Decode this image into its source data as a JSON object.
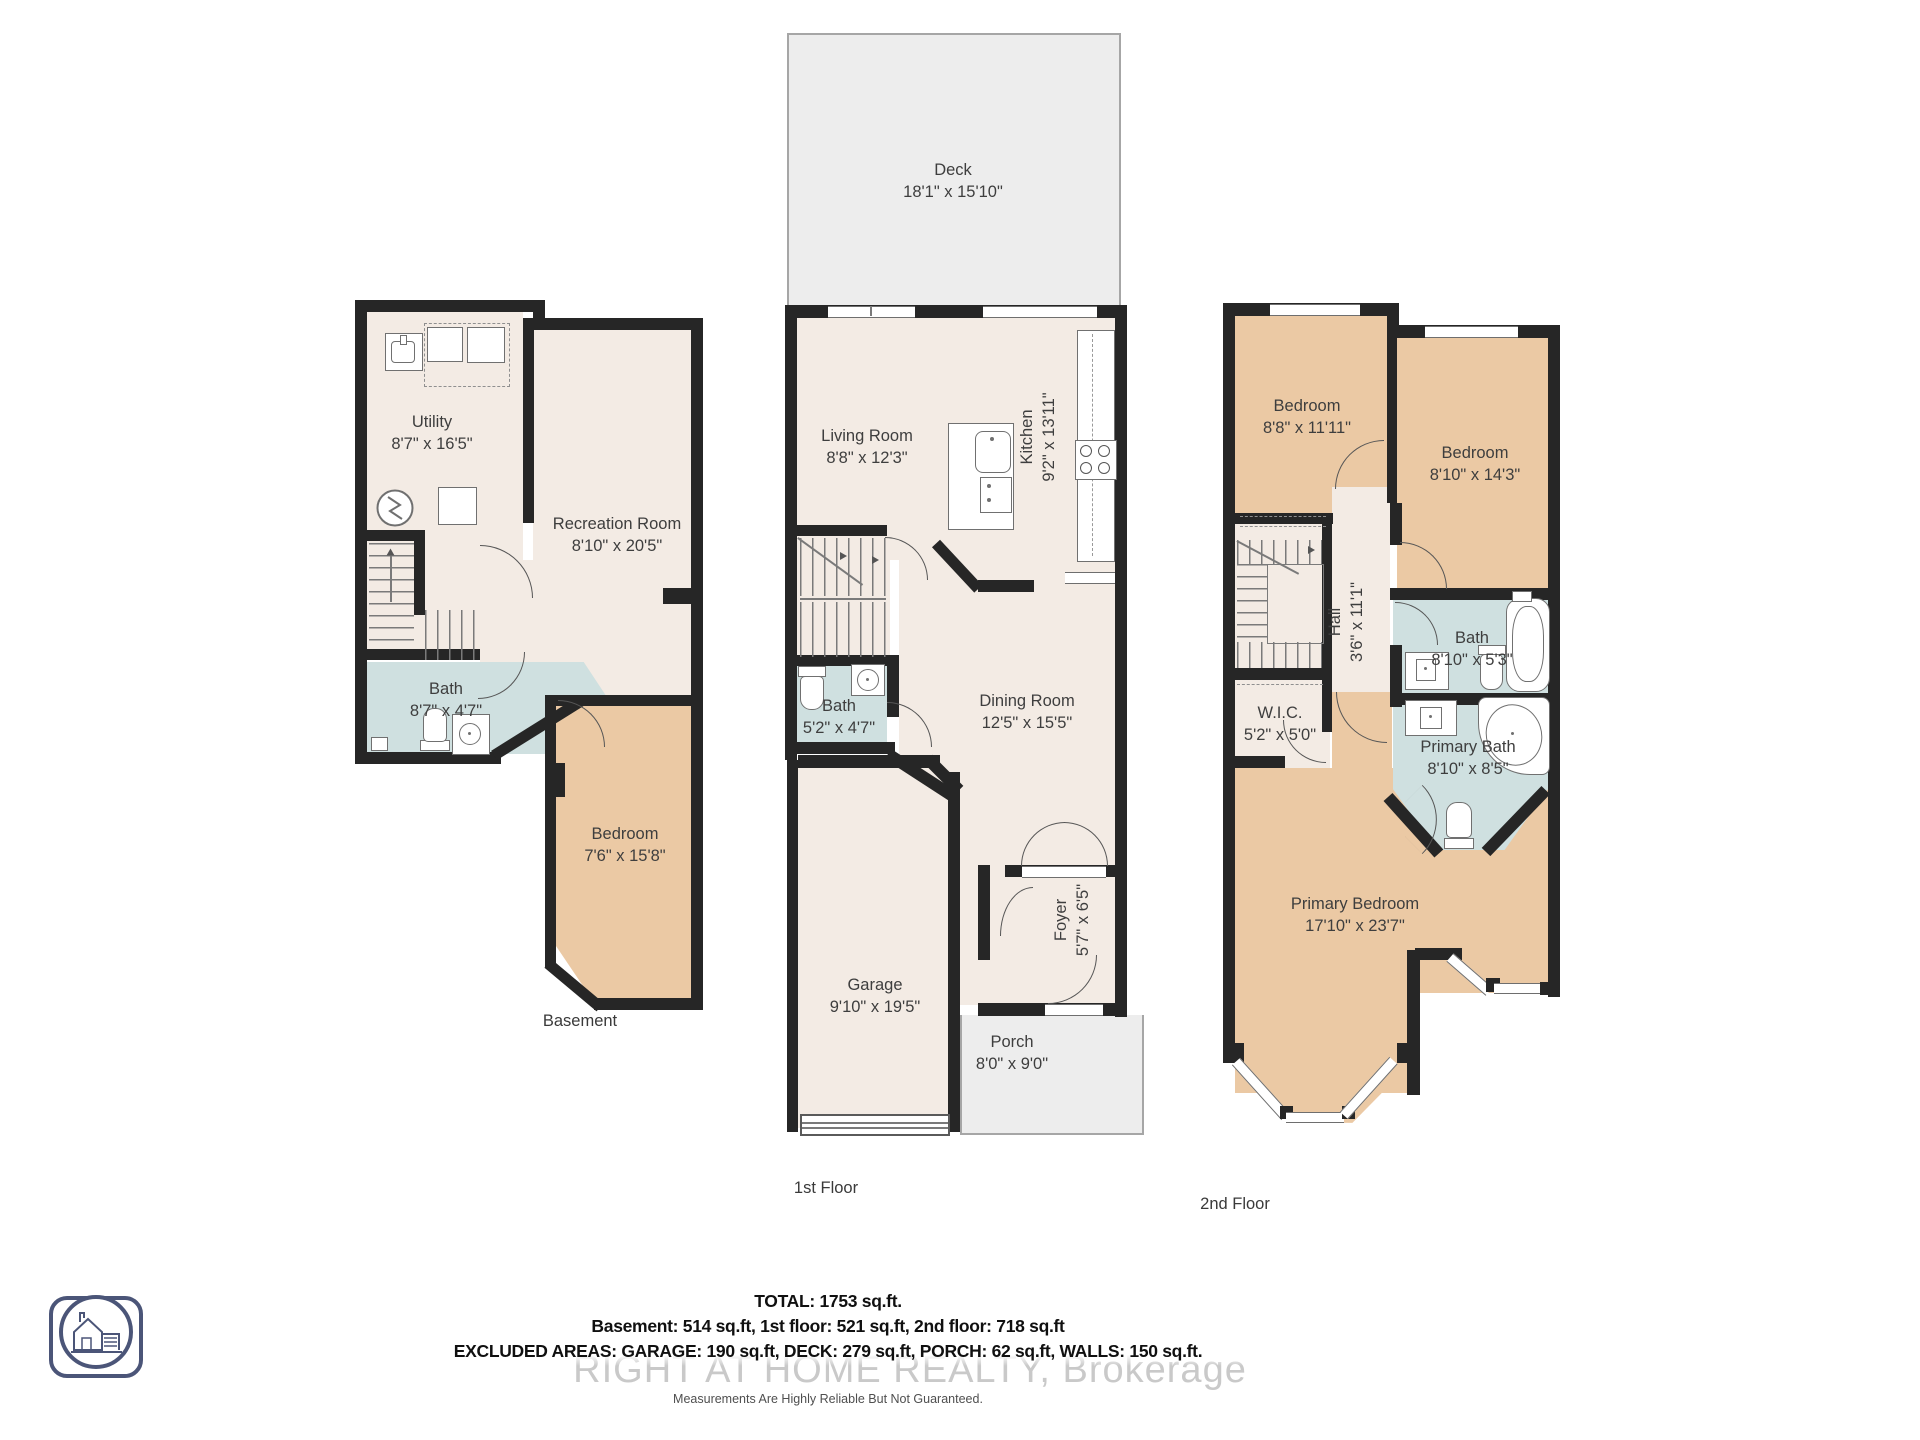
{
  "floors": {
    "basement": {
      "label": "Basement",
      "rooms": {
        "utility": {
          "name": "Utility",
          "dims": "8'7\" x 16'5\""
        },
        "recreation": {
          "name": "Recreation Room",
          "dims": "8'10\" x 20'5\""
        },
        "bath": {
          "name": "Bath",
          "dims": "8'7\" x 4'7\""
        },
        "bedroom": {
          "name": "Bedroom",
          "dims": "7'6\" x 15'8\""
        }
      }
    },
    "first": {
      "label": "1st Floor",
      "rooms": {
        "deck": {
          "name": "Deck",
          "dims": "18'1\" x 15'10\""
        },
        "living": {
          "name": "Living Room",
          "dims": "8'8\" x 12'3\""
        },
        "kitchen": {
          "name": "Kitchen",
          "dims": "9'2\" x 13'11\""
        },
        "bath": {
          "name": "Bath",
          "dims": "5'2\" x 4'7\""
        },
        "dining": {
          "name": "Dining Room",
          "dims": "12'5\" x 15'5\""
        },
        "foyer": {
          "name": "Foyer",
          "dims": "5'7\" x 6'5\""
        },
        "garage": {
          "name": "Garage",
          "dims": "9'10\" x 19'5\""
        },
        "porch": {
          "name": "Porch",
          "dims": "8'0\" x 9'0\""
        }
      }
    },
    "second": {
      "label": "2nd Floor",
      "rooms": {
        "bedroom1": {
          "name": "Bedroom",
          "dims": "8'8\" x 11'11\""
        },
        "bedroom2": {
          "name": "Bedroom",
          "dims": "8'10\" x 14'3\""
        },
        "hall": {
          "name": "Hall",
          "dims": "3'6\" x 11'1\""
        },
        "bath": {
          "name": "Bath",
          "dims": "8'10\" x 5'3\""
        },
        "wic": {
          "name": "W.I.C.",
          "dims": "5'2\" x 5'0\""
        },
        "primary_bath": {
          "name": "Primary Bath",
          "dims": "8'10\" x 8'5\""
        },
        "primary_bedroom": {
          "name": "Primary Bedroom",
          "dims": "17'10\" x 23'7\""
        }
      }
    }
  },
  "summary": {
    "total": "TOTAL: 1753 sq.ft.",
    "floors_line": "Basement: 514 sq.ft, 1st floor: 521 sq.ft, 2nd floor: 718 sq.ft",
    "excluded_line": "EXCLUDED AREAS: GARAGE: 190 sq.ft, DECK: 279 sq.ft, PORCH: 62 sq.ft, WALLS: 150 sq.ft.",
    "watermark": "RIGHT AT HOME REALTY, Brokerage",
    "disclaimer": "Measurements Are Highly Reliable But Not Guaranteed."
  },
  "colors": {
    "wall": "#262626",
    "living_area_fill": "#f3ebe4",
    "bedroom_fill": "#ebc9a4",
    "bath_fill": "#cfe0e0",
    "outdoor_fill": "#ededed",
    "label_text": "#3e3e3e",
    "watermark_text": "#c9c9c9",
    "logo_stroke": "#4b5578"
  },
  "icons": {
    "washer-icon": "square outline",
    "dryer-icon": "square outline",
    "laundry-sink-icon": "square with basin",
    "sump-pump-icon": "circle with zigzag",
    "toilet-icon": "rounded bowl with tank",
    "shower-icon": "square with round drain",
    "sink-icon": "basin with faucet dot",
    "stove-icon": "four burners",
    "dishwasher-icon": "rect with dots",
    "bathtub-icon": "rounded rect with oval",
    "corner-tub-icon": "rounded corner with oval",
    "stairs-icon": "tread lines with arrow",
    "door-arc-icon": "quarter-circle swing",
    "window-icon": "double parallel lines",
    "house-logo": "rounded square camera with circle and house"
  }
}
